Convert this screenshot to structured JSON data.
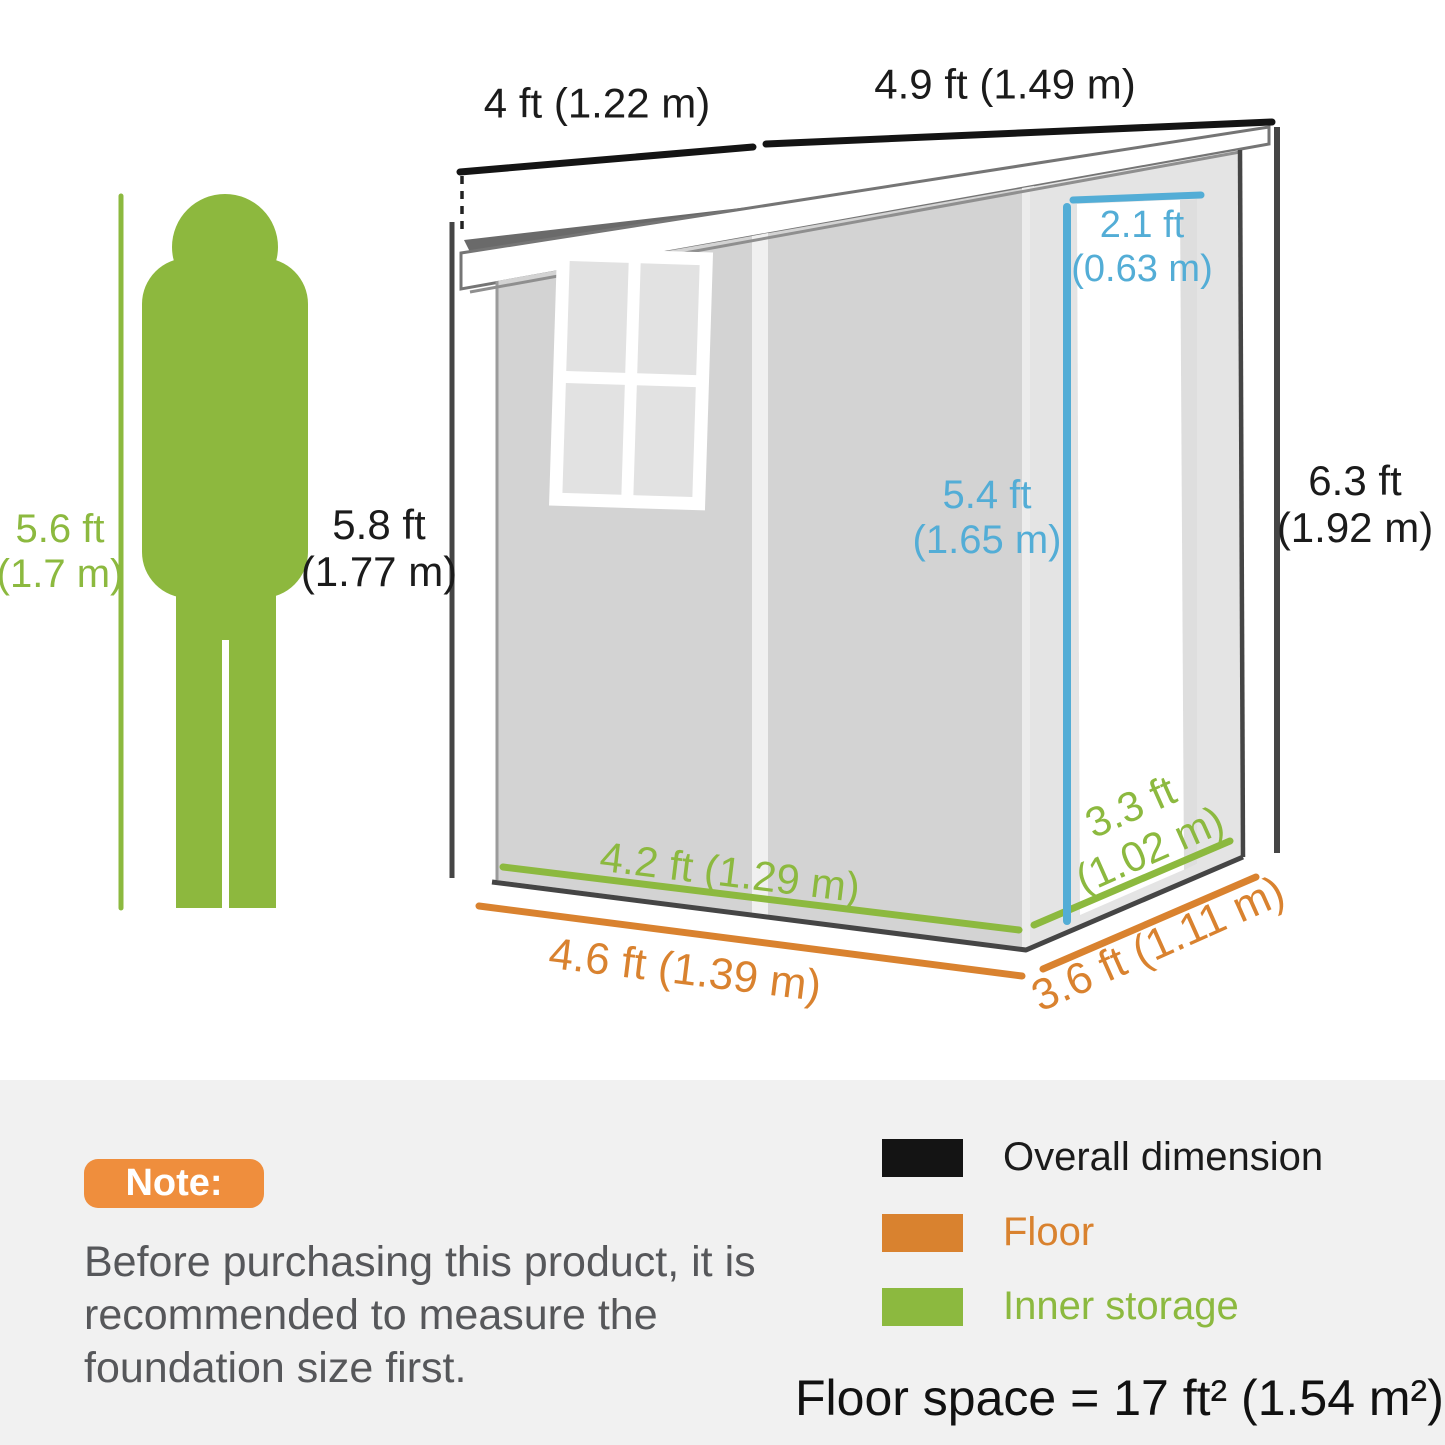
{
  "diagram": {
    "roof_depth_label": "4 ft (1.22 m)",
    "roof_width_label": "4.9 ft (1.49 m)",
    "door_width": {
      "l1": "2.1 ft",
      "l2": "(0.63 m)"
    },
    "door_height": {
      "l1": "5.4 ft",
      "l2": "(1.65 m)"
    },
    "overall_height": {
      "l1": "6.3 ft",
      "l2": "(1.92 m)"
    },
    "person_height_metric": {
      "l1": "5.6 ft",
      "l2": "(1.7 m)"
    },
    "person_height": {
      "l1": "5.8 ft",
      "l2": "(1.77 m)"
    },
    "inner_width_label": "4.2 ft (1.29 m)",
    "inner_depth": {
      "l1": "3.3 ft",
      "l2": "(1.02 m)"
    },
    "floor_width_label": "4.6 ft (1.39 m)",
    "floor_depth_label": "3.6 ft (1.11 m)"
  },
  "note": {
    "badge_label": "Note:",
    "body": "Before purchasing this product, it is recommended to measure the foundation size first."
  },
  "legend": {
    "items": [
      {
        "label": "Overall dimension",
        "color": "#141414"
      },
      {
        "label": "Floor",
        "color": "#D9822F"
      },
      {
        "label": "Inner storage",
        "color": "#8CB93F"
      }
    ],
    "floor_space": "Floor space = 17 ft² (1.54 m²)"
  },
  "colors": {
    "overall_black": "#141414",
    "floor_orange": "#D9822F",
    "inner_green": "#8CB93F",
    "door_blue": "#53ADD6",
    "note_badge_orange": "#EF8E3D",
    "roof_gray": "#6A6A6A",
    "wall_front_gray": "#D3D3D3",
    "wall_side_gray": "#E4E4E4",
    "panel_background": "#F1F1F1"
  }
}
